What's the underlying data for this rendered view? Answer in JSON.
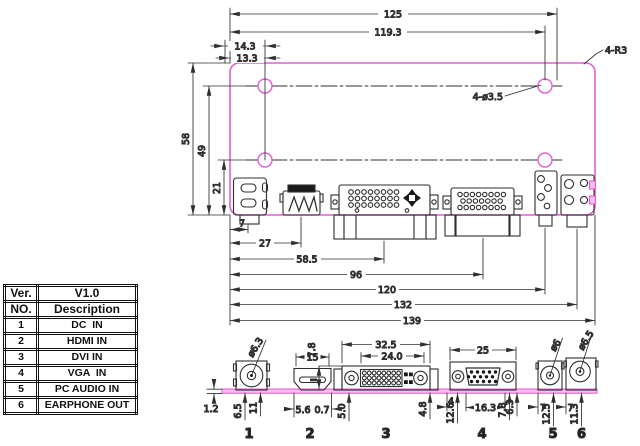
{
  "table": {
    "ver_label": "Ver.",
    "ver_value": "V1.0",
    "no_label": "NO.",
    "desc_label": "Description",
    "rows": [
      {
        "no": "1",
        "desc": "DC  IN"
      },
      {
        "no": "2",
        "desc": "HDMI IN"
      },
      {
        "no": "3",
        "desc": "DVI IN"
      },
      {
        "no": "4",
        "desc": "VGA  IN"
      },
      {
        "no": "5",
        "desc": "PC AUDIO IN"
      },
      {
        "no": "6",
        "desc": "EARPHONE OUT"
      }
    ]
  },
  "top_view": {
    "d125": "125",
    "d119_3": "119.3",
    "d14_3": "14.3",
    "d13_3": "13.3",
    "corner_note": "4-R3",
    "hole_note": "4-ø3.5",
    "d58": "58",
    "d49": "49",
    "d21": "21",
    "d7": "7",
    "d27": "27",
    "d58_5": "58.5",
    "d96": "96",
    "d120": "120",
    "d132": "132",
    "d139": "139"
  },
  "front_view": {
    "dc_dia": "ø6.3",
    "pcb_thickness": "1.2",
    "dc_d1": "6.5",
    "dc_d2": "11",
    "hdmi_w": "15",
    "hdmi_d1": "5.6",
    "hdmi_d2": "0.7",
    "dvi_h": "7.8",
    "dvi_w": "32.5",
    "dvi_pin_w": "24.0",
    "dvi_d1": "5.0",
    "dvi_d2": "4.8",
    "vga_w": "25",
    "vga_d1": "4",
    "vga_d2": "12.6",
    "vga_d3": "16.3",
    "vga_d4": "7.8",
    "vga_d5": "6.3",
    "audio_dia": "ø6",
    "audio_d1": "7",
    "audio_d2": "12.5",
    "ep_dia": "ø6.5",
    "ep_d1": "7",
    "ep_d2": "11.3",
    "num1": "1",
    "num2": "2",
    "num3": "3",
    "num4": "4",
    "num5": "5",
    "num6": "6"
  },
  "colors": {
    "board": "#e45ed2",
    "board_fill": "#f4bdec",
    "line": "#2f2f2f"
  }
}
